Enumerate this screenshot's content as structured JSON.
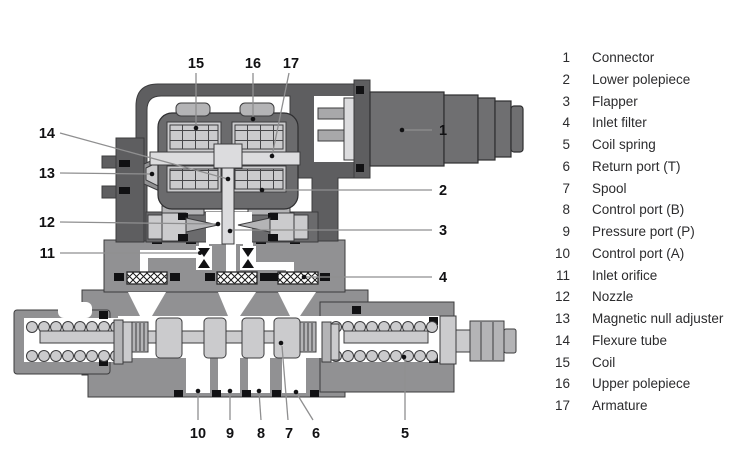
{
  "legend": {
    "items": [
      {
        "num": "1",
        "label": "Connector"
      },
      {
        "num": "2",
        "label": "Lower polepiece"
      },
      {
        "num": "3",
        "label": "Flapper"
      },
      {
        "num": "4",
        "label": "Inlet filter"
      },
      {
        "num": "5",
        "label": "Coil spring"
      },
      {
        "num": "6",
        "label": "Return port (T)"
      },
      {
        "num": "7",
        "label": "Spool"
      },
      {
        "num": "8",
        "label": "Control port (B)"
      },
      {
        "num": "9",
        "label": "Pressure port (P)"
      },
      {
        "num": "10",
        "label": "Control port (A)"
      },
      {
        "num": "11",
        "label": "Inlet orifice"
      },
      {
        "num": "12",
        "label": "Nozzle"
      },
      {
        "num": "13",
        "label": "Magnetic null adjuster"
      },
      {
        "num": "14",
        "label": "Flexure tube"
      },
      {
        "num": "15",
        "label": "Coil"
      },
      {
        "num": "16",
        "label": "Upper polepiece"
      },
      {
        "num": "17",
        "label": "Armature"
      }
    ]
  },
  "colors": {
    "housing_dark": "#5e5e60",
    "motor_frame": "#6b6b6d",
    "connector_gray": "#6f6f71",
    "valve_body_gray": "#919193",
    "part_mid_gray": "#b4b4b6",
    "part_light_gray": "#cbcbcd",
    "part_lighter_gray": "#dcdcde",
    "line_black": "#111113",
    "leader_gray": "#8f8f90",
    "background": "#ffffff"
  }
}
